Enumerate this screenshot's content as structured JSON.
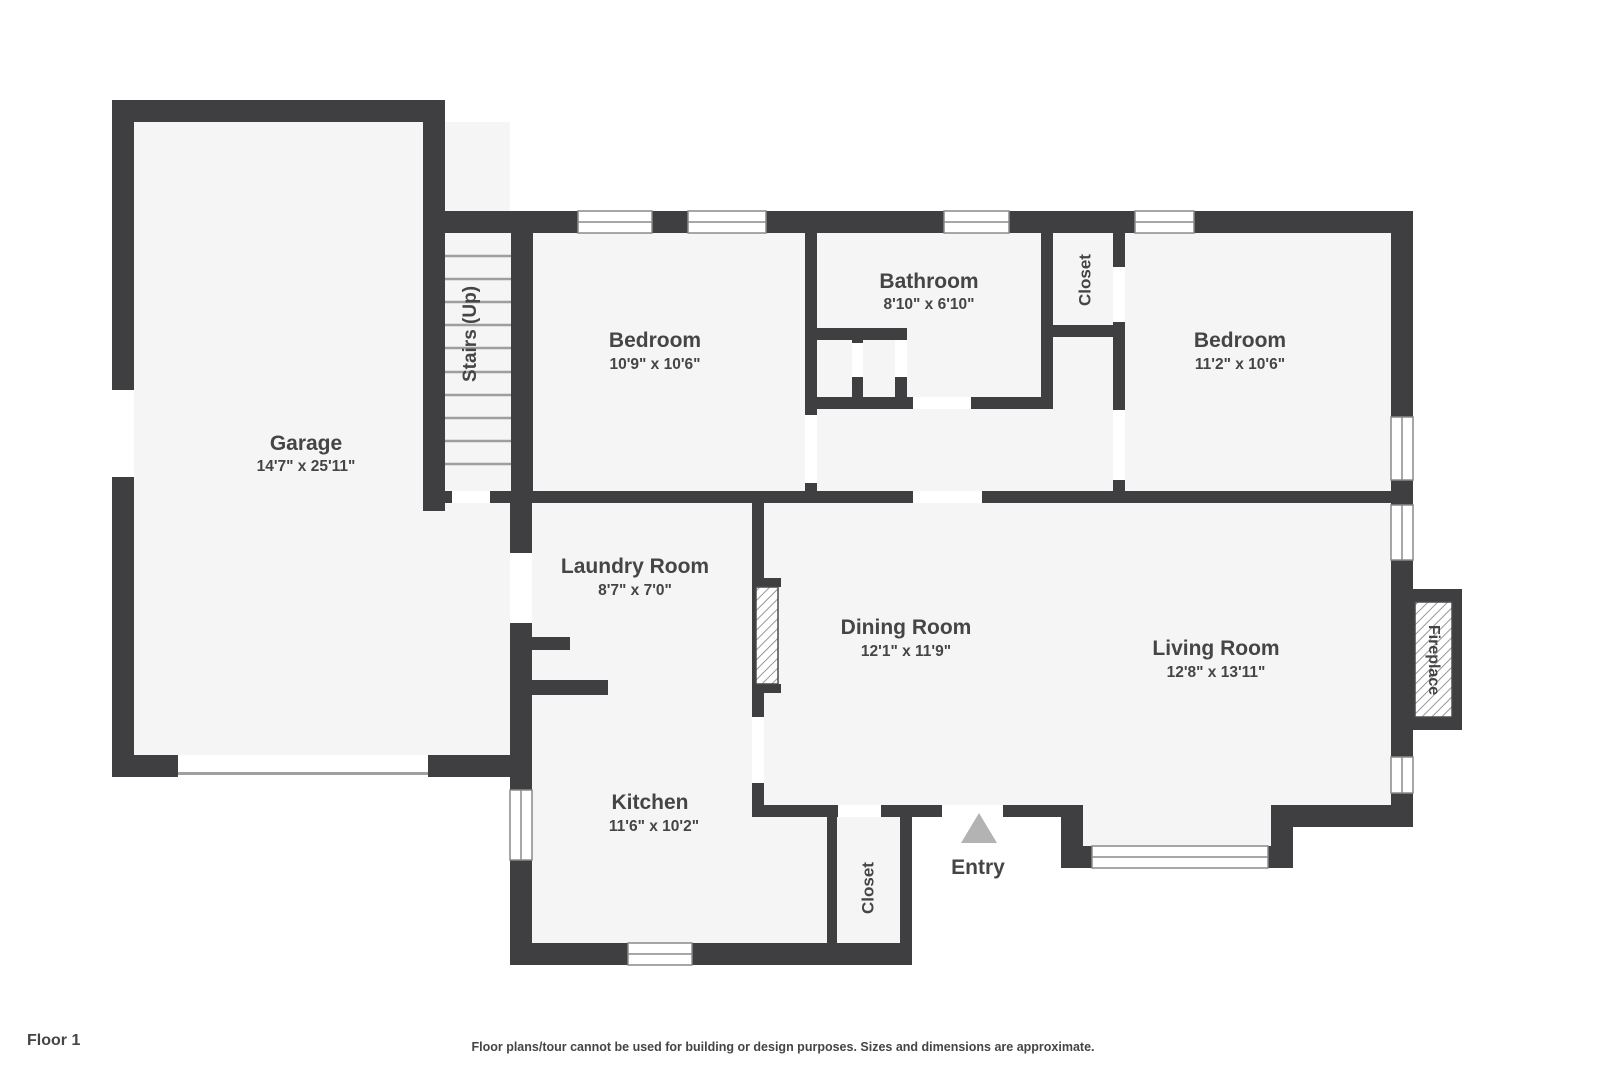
{
  "footer": {
    "floor_label": "Floor 1",
    "disclaimer": "Floor plans/tour cannot be used for building or design purposes. Sizes and dimensions are approximate."
  },
  "colors": {
    "wall": "#3f3f41",
    "floor": "#f5f5f5",
    "text": "#454545",
    "entry_arrow": "#b3b3b3",
    "stair_tread": "#9e9e9e"
  },
  "rooms": {
    "garage": {
      "name": "Garage",
      "dims": "14'7\" x 25'11\""
    },
    "stairs": {
      "name": "Stairs (Up)"
    },
    "bedroom1": {
      "name": "Bedroom",
      "dims": "10'9\" x 10'6\""
    },
    "bathroom": {
      "name": "Bathroom",
      "dims": "8'10\" x 6'10\""
    },
    "closet_top": {
      "name": "Closet"
    },
    "bedroom2": {
      "name": "Bedroom",
      "dims": "11'2\" x 10'6\""
    },
    "laundry": {
      "name": "Laundry Room",
      "dims": "8'7\" x 7'0\""
    },
    "dining": {
      "name": "Dining Room",
      "dims": "12'1\" x 11'9\""
    },
    "living": {
      "name": "Living Room",
      "dims": "12'8\" x 13'11\""
    },
    "kitchen": {
      "name": "Kitchen",
      "dims": "11'6\" x 10'2\""
    },
    "closet_entry": {
      "name": "Closet"
    },
    "entry": {
      "name": "Entry"
    },
    "fireplace": {
      "name": "Fireplace"
    }
  }
}
